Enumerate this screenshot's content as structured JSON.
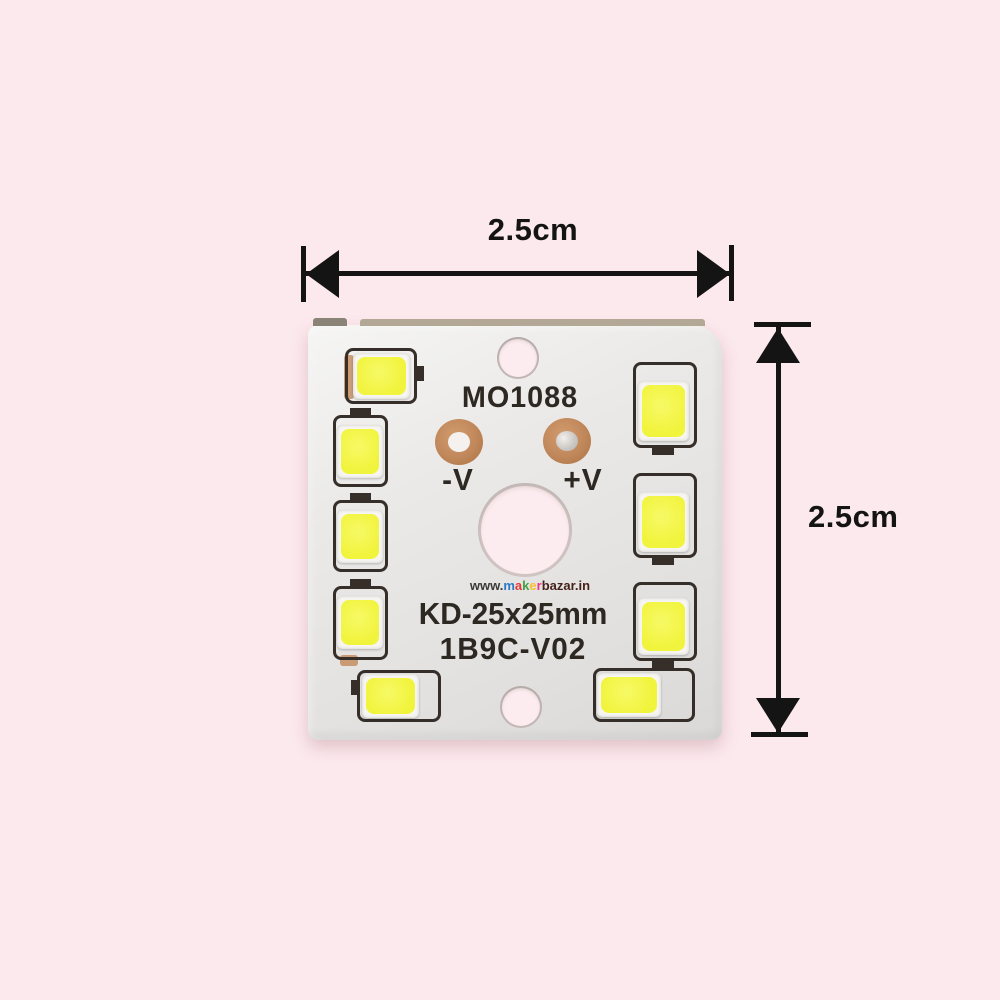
{
  "colors": {
    "bg": "#fce9ed",
    "board": "#eae9e7",
    "board_edge": "#b3a796",
    "led": "#f1f43d",
    "pkg": "#f7f5f1",
    "outline": "#362e28",
    "copper": "#c0875a",
    "silk": "#2e2823",
    "arrow": "#141414",
    "hole": "#fdecef"
  },
  "dimensions": {
    "width_label": "2.5cm",
    "height_label": "2.5cm"
  },
  "pcb": {
    "model": "MO1088",
    "negative_terminal": "-V",
    "positive_terminal": "+V",
    "size_code": "KD-25x25mm",
    "version_code": "1B9C-V02",
    "led_count": 9
  },
  "watermark": {
    "prefix": "www.",
    "brand_letters": [
      {
        "ch": "m",
        "color": "#2979c9"
      },
      {
        "ch": "a",
        "color": "#e53935"
      },
      {
        "ch": "k",
        "color": "#43a047"
      },
      {
        "ch": "e",
        "color": "#fbc02d"
      },
      {
        "ch": "r",
        "color": "#e5398a"
      }
    ],
    "suffix": "bazar.in",
    "prefix_color": "#3a3a3a",
    "suffix_color": "#45211a"
  }
}
